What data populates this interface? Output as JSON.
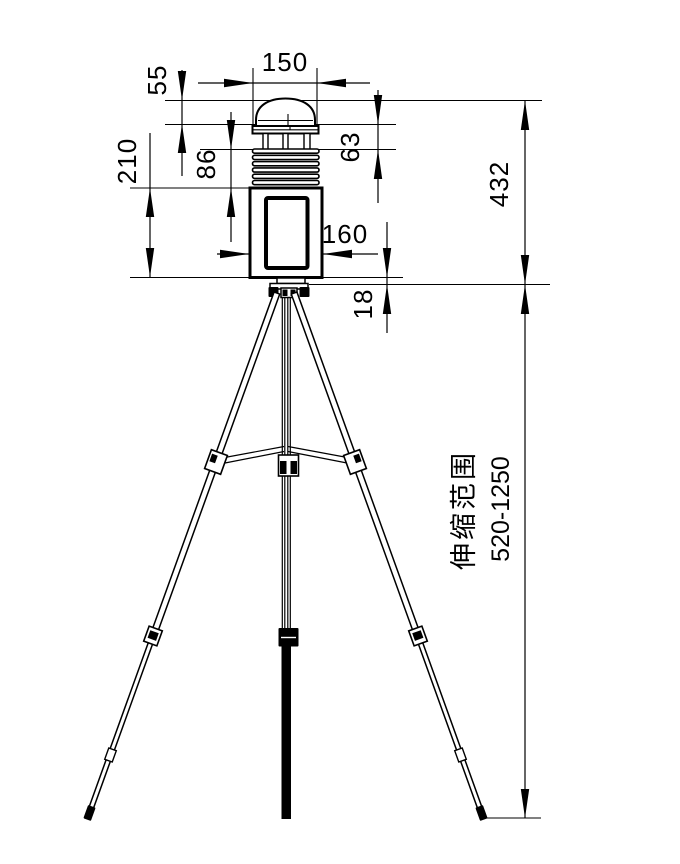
{
  "drawing": {
    "type": "technical-dimension-drawing",
    "subject": "weather-station-on-tripod",
    "line_color": "#000000",
    "background_color": "#ffffff",
    "dimensions": {
      "cap_width": "150",
      "dome_height": "55",
      "post_section_height": "63",
      "louver_stack_height": "86",
      "body_height": "210",
      "body_width": "160",
      "mount_gap": "18",
      "station_total_height": "432",
      "telescopic_label": "伸缩范围",
      "telescopic_range": "520-1250"
    }
  }
}
